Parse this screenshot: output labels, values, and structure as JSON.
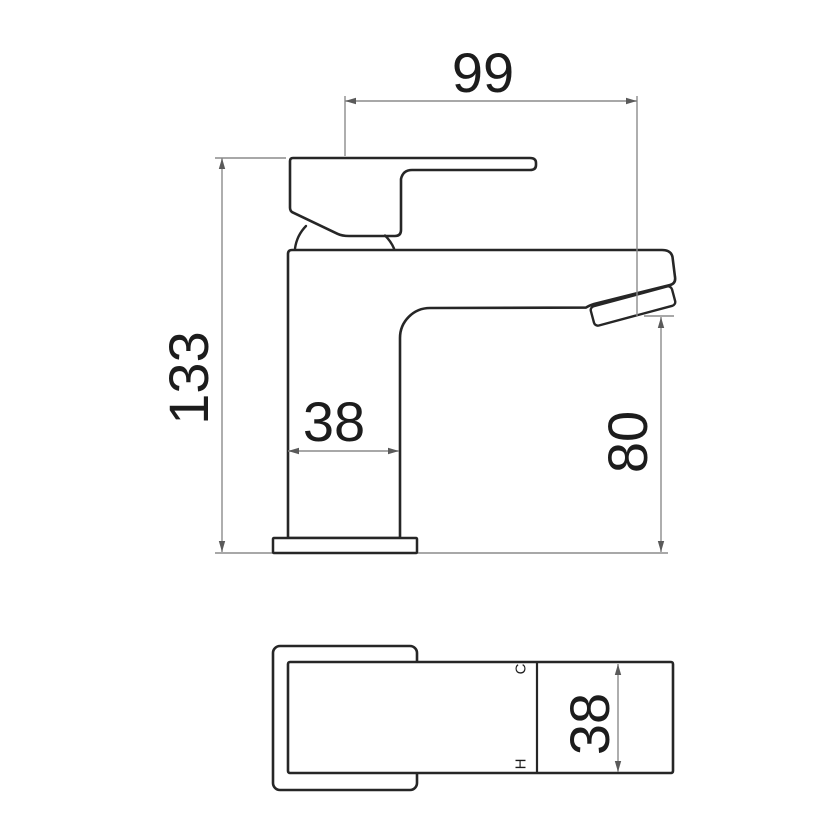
{
  "colors": {
    "background": "#ffffff",
    "outline": "#262626",
    "dimension": "#8c8c8c",
    "arrow": "#5a5a5a",
    "text": "#1c1c1c"
  },
  "side_view": {
    "dimensions": {
      "spout_reach_mm": "99",
      "overall_height_mm": "133",
      "body_width_mm": "38",
      "spout_outlet_height_mm": "80"
    }
  },
  "plan_view": {
    "dimensions": {
      "body_depth_mm": "38"
    },
    "port_labels": {
      "cold": "C",
      "hot": "H"
    }
  }
}
